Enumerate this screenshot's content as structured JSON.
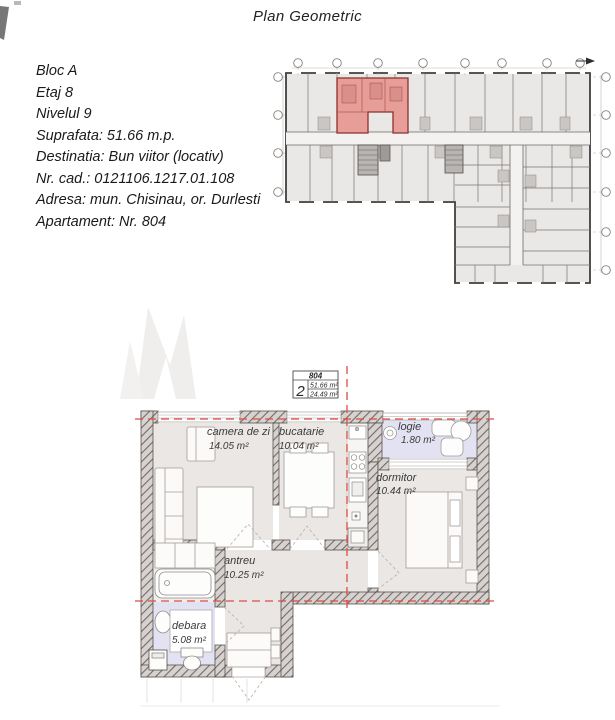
{
  "page": {
    "title": "Plan Geometric"
  },
  "info": {
    "lines": [
      "Bloc A",
      "Etaj 8",
      "Nivelul 9",
      "Suprafata: 51.66 m.p.",
      "Destinatia: Bun viitor (locativ)",
      "Nr. cad.: 0121106.1217.01.108",
      "Adresa: mun. Chisinau, or. Durlesti",
      "Apartament: Nr. 804"
    ]
  },
  "summary_box": {
    "apartment_number": "804",
    "room_count": "2",
    "total_area": "51.66 m²",
    "living_area": "24.49 m²"
  },
  "detail_plan": {
    "rooms": [
      {
        "name": "camera de zi",
        "area": "14.05 m²"
      },
      {
        "name": "bucatarie",
        "area": "10.04 m²"
      },
      {
        "name": "logie",
        "area": "1.80 m²"
      },
      {
        "name": "dormitor",
        "area": "10.44 m²"
      },
      {
        "name": "antreu",
        "area": "10.25 m²"
      },
      {
        "name": "debara",
        "area": "5.08 m²"
      }
    ]
  },
  "colors": {
    "axis_red": "#df4b45",
    "highlight_red": "#e79e99",
    "room_fill": "#ebe7e5",
    "loggia_fill": "#e2e2f3",
    "wall_dark": "#57534f"
  }
}
